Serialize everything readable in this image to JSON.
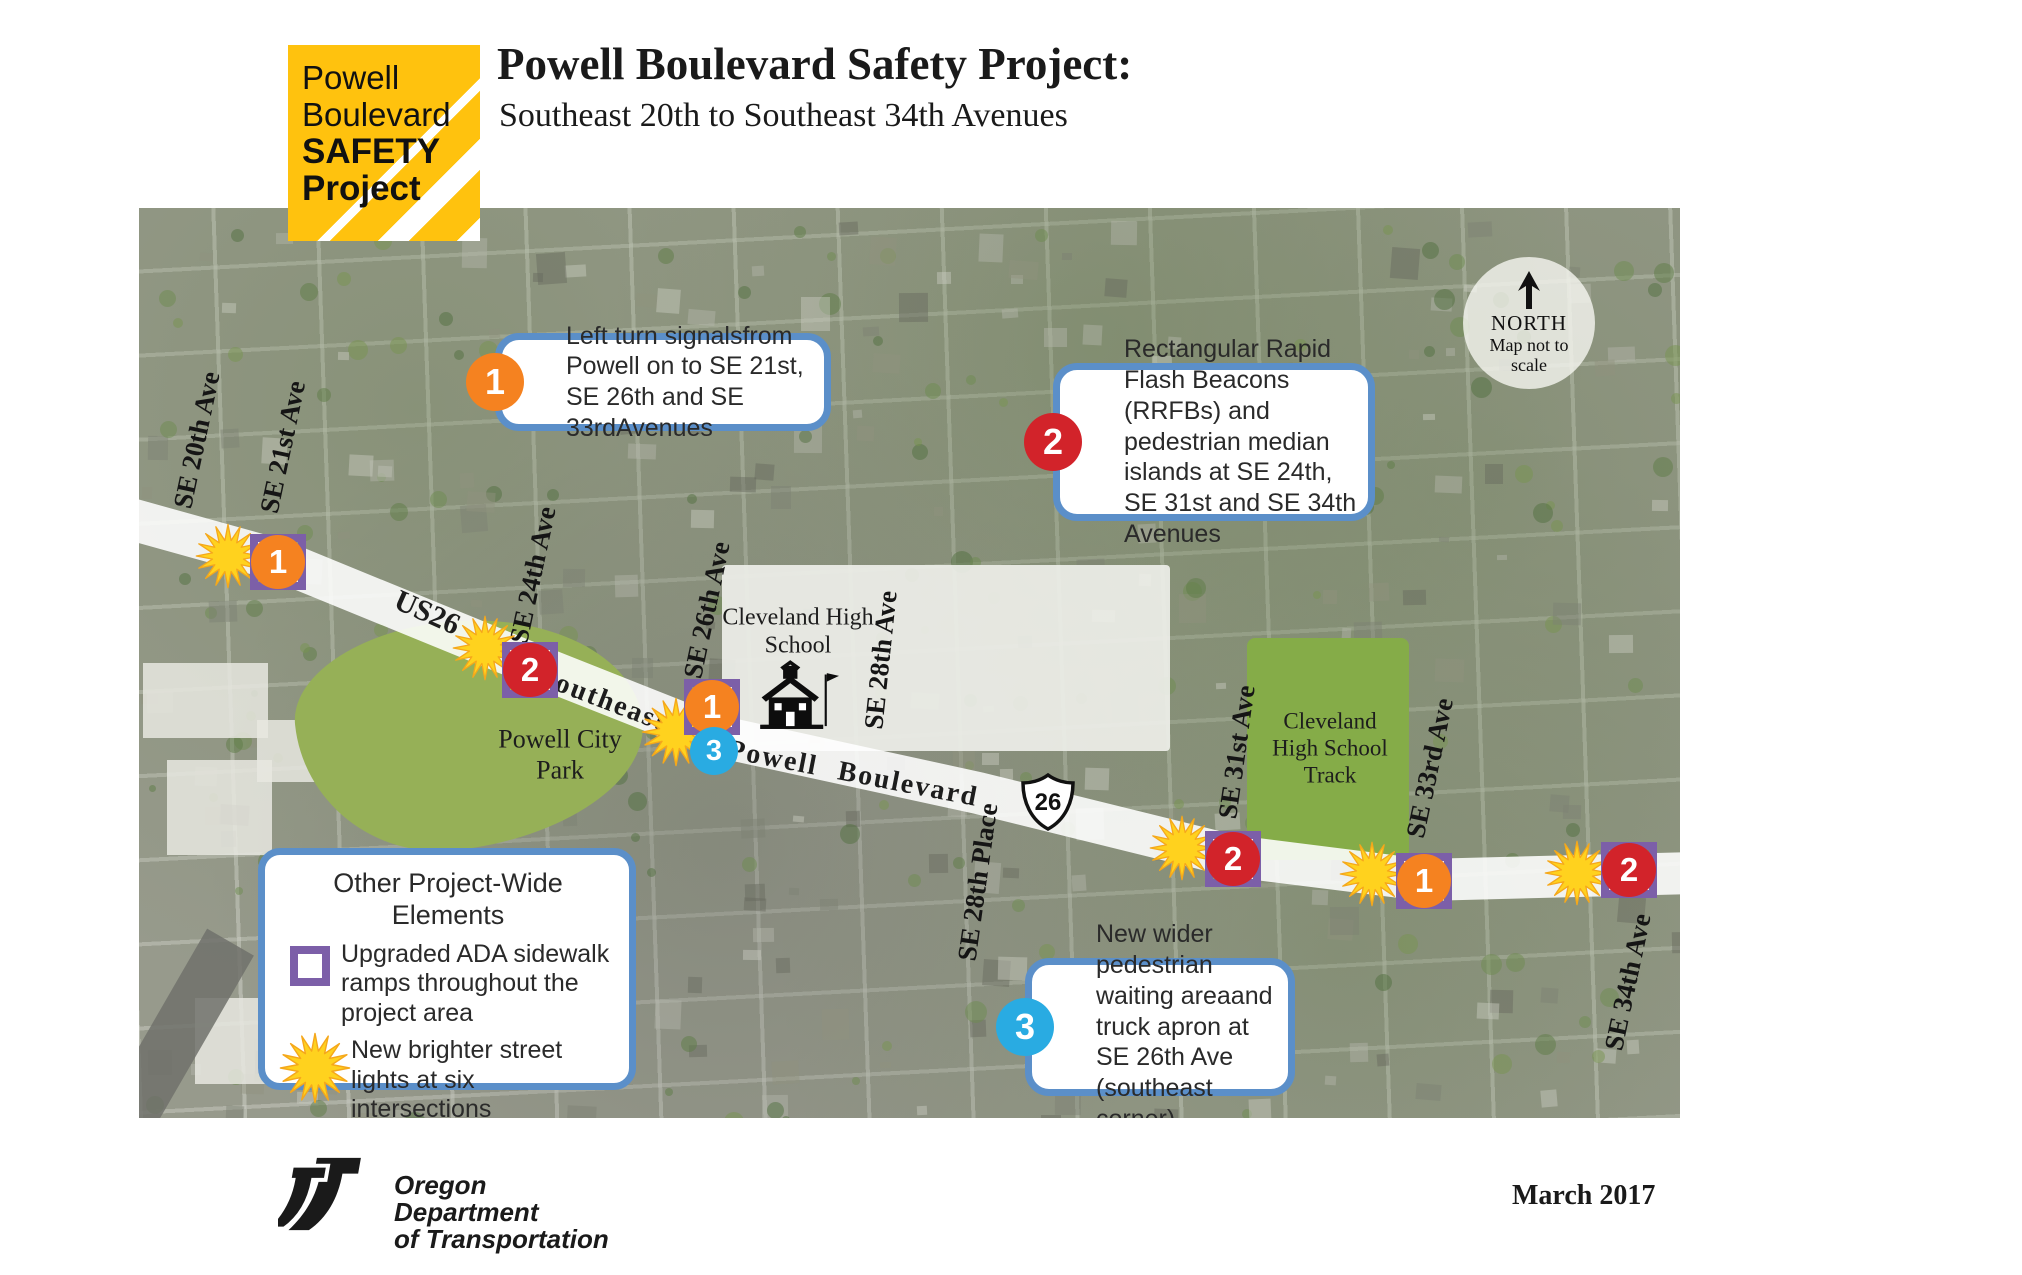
{
  "colors": {
    "logo_yellow": "#FFC20E",
    "callout_border": "#5B8FC9",
    "orange": "#F58220",
    "red": "#D2232A",
    "blue": "#29ABE2",
    "purple": "#7C5FA8",
    "star_yellow": "#FFD21E",
    "star_edge": "#F5A81B"
  },
  "logo": {
    "line1": "Powell",
    "line2": "Boulevard",
    "line3": "SAFETY",
    "line4": "Project"
  },
  "header": {
    "title": "Powell Boulevard Safety Project:",
    "subtitle": "Southeast 20th to Southeast 34th Avenues"
  },
  "map": {
    "north_badge": {
      "label": "NORTH",
      "note": "Map not to scale"
    },
    "street_labels": [
      {
        "name": "SE 20th Ave"
      },
      {
        "name": "SE 21st Ave"
      },
      {
        "name": "SE 24th Ave"
      },
      {
        "name": "SE 26th Ave"
      },
      {
        "name": "SE 28th Ave"
      },
      {
        "name": "SE 28th Place"
      },
      {
        "name": "SE 31st Ave"
      },
      {
        "name": "SE 33rd Ave"
      },
      {
        "name": "SE 34th Ave"
      }
    ],
    "road_labels": [
      {
        "text": "US26"
      },
      {
        "text": "Southeast"
      },
      {
        "text": "Powell  Boulevard"
      }
    ],
    "route_shield": {
      "number": "26"
    },
    "places": [
      {
        "name": "Cleveland High School"
      },
      {
        "name": "Powell City Park"
      },
      {
        "name": "Cleveland High School Track"
      }
    ],
    "markers": [
      {
        "number": "1",
        "street": "SE 21st Ave"
      },
      {
        "number": "2",
        "street": "SE 24th Ave"
      },
      {
        "number": "1",
        "street": "SE 26th Ave"
      },
      {
        "number": "3",
        "street": "SE 26th Ave"
      },
      {
        "number": "2",
        "street": "SE 31st Ave"
      },
      {
        "number": "1",
        "street": "SE 33rd Ave"
      },
      {
        "number": "2",
        "street": "SE 34th Ave"
      }
    ]
  },
  "callouts": [
    {
      "number": "1",
      "text": "Left turn signalsfrom Powell on to SE 21st, SE 26th and SE 33rdAvenues"
    },
    {
      "number": "2",
      "text": "Rectangular Rapid Flash Beacons (RRFBs) and pedestrian median islands at SE 24th, SE 31st and SE 34th Avenues"
    },
    {
      "number": "3",
      "text": "New wider pedestrian waiting areaand truck apron at SE 26th Ave (southeast corner)"
    }
  ],
  "legend": {
    "title": "Other Project-Wide Elements",
    "items": [
      {
        "icon": "ada-square-icon",
        "text": "Upgraded ADA sidewalk ramps throughout the project area"
      },
      {
        "icon": "street-light-starburst-icon",
        "text": "New brighter street lights at six intersections"
      }
    ]
  },
  "footer": {
    "agency_line1": "Oregon",
    "agency_line2": "Department",
    "agency_line3": "of Transportation",
    "date": "March 2017"
  }
}
